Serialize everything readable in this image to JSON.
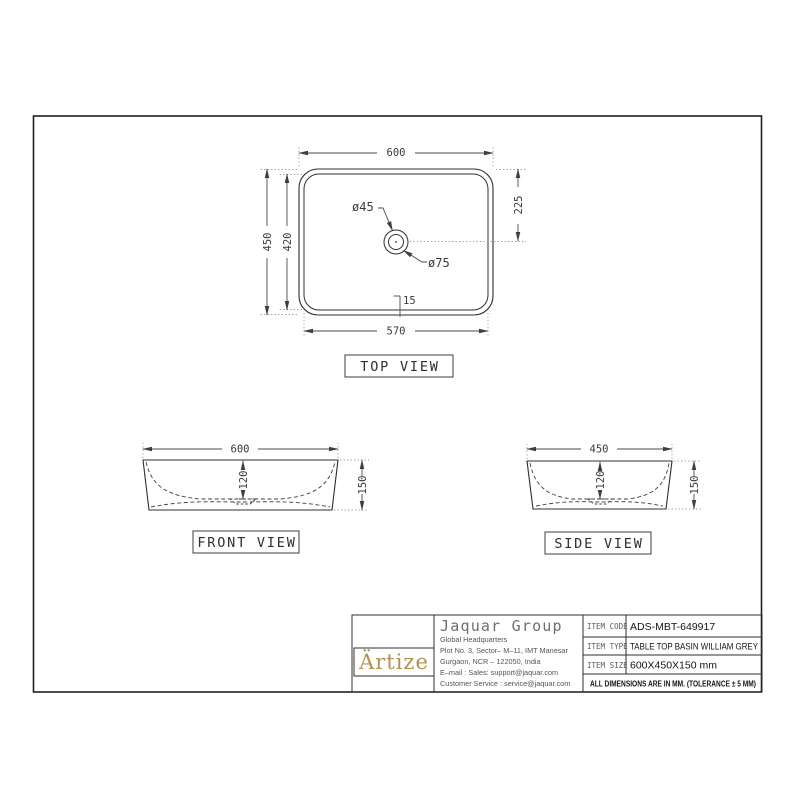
{
  "drawing": {
    "views": {
      "top": {
        "label": "TOP VIEW",
        "dim_outer_width": "600",
        "dim_outer_height": "450",
        "dim_inner_height": "420",
        "dim_center_offset": "225",
        "dim_inner_width": "570",
        "dim_rim": "15",
        "dim_drain_inner": "ø45",
        "dim_drain_outer": "ø75"
      },
      "front": {
        "label": "FRONT VIEW",
        "dim_width": "600",
        "dim_depth": "120",
        "dim_height": "150"
      },
      "side": {
        "label": "SIDE VIEW",
        "dim_width": "450",
        "dim_depth": "120",
        "dim_height": "150"
      }
    },
    "title_block": {
      "logo_text": "Ärtize",
      "company_name": "Jaquar Group",
      "address_lines": [
        "Global Headquarters",
        "Plot No. 3, Sector– M–11, IMT Manesar",
        "Gurgaon, NCR – 122050, India",
        "E–mail : Sales: support@jaquar.com",
        "Customer Service : service@jaquar.com"
      ],
      "fields": [
        {
          "label": "ITEM CODE",
          "value": "ADS-MBT-649917"
        },
        {
          "label": "ITEM TYPE",
          "value": "TABLE TOP BASIN WILLIAM GREY"
        },
        {
          "label": "ITEM SIZE",
          "value": "600X450X150 mm"
        }
      ],
      "note": "ALL DIMENSIONS ARE IN MM. (TOLERANCE ± 5 MM)"
    },
    "colors": {
      "line": "#2f2f2f",
      "dim": "#4a4a4a",
      "gold": "#b5924c"
    }
  }
}
